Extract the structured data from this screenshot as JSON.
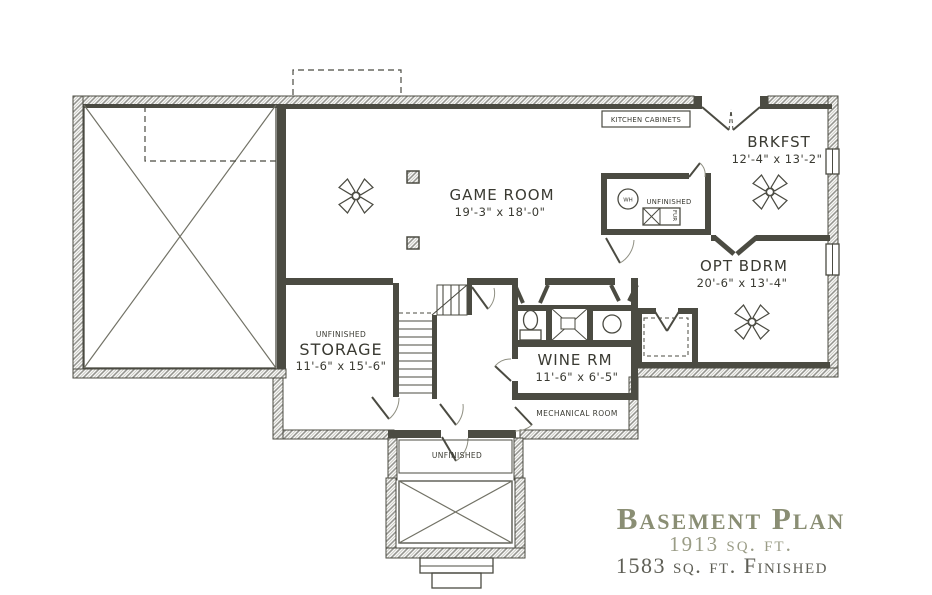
{
  "plan": {
    "rooms": {
      "game_room": {
        "name": "GAME ROOM",
        "dims": "19'-3\" x 18'-0\""
      },
      "brkfst": {
        "name": "BRKFST",
        "dims": "12'-4\" x 13'-2\""
      },
      "opt_bdrm": {
        "name": "OPT BDRM",
        "dims": "20'-6\" x 13'-4\""
      },
      "storage": {
        "finish": "UNFINISHED",
        "name": "STORAGE",
        "dims": "11'-6\" x 15'-6\""
      },
      "wine_rm": {
        "name": "WINE RM",
        "dims": "11'-6\" x 6'-5\""
      },
      "mechanical": {
        "name": "MECHANICAL ROOM"
      },
      "utility": {
        "finish": "UNFINISHED",
        "water_heater": "WH",
        "furnace": "FUR"
      },
      "entry": {
        "finish": "UNFINISHED"
      }
    },
    "annotations": {
      "kitchen_cabinets": "KITCHEN CABINETS"
    },
    "title_block": {
      "title": "Basement Plan",
      "total_area": "1913 sq. ft.",
      "finished_area": "1583 sq. ft. Finished"
    }
  },
  "colors": {
    "wall": "#4b4b42",
    "title_olive": "#8a8e74",
    "subtitle_light": "#9a9c86",
    "subtitle_dark": "#5e5e55"
  }
}
